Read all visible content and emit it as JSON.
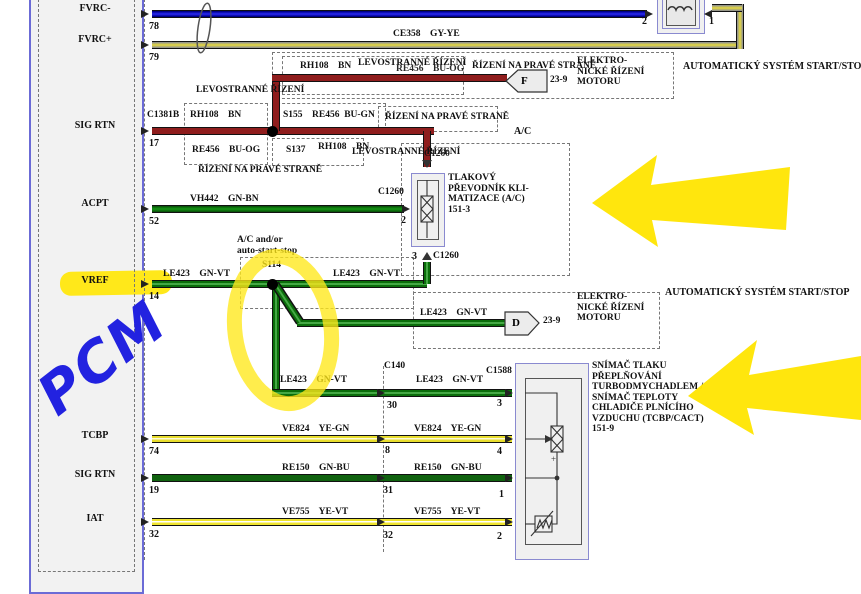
{
  "pcm": {
    "handwritten": "PCM",
    "pins": [
      {
        "label": "FVRC-",
        "num": "78"
      },
      {
        "label": "FVRC+",
        "num": "79"
      },
      {
        "label": "SIG RTN",
        "num": "17"
      },
      {
        "label": "ACPT",
        "num": "52"
      },
      {
        "label": "VREF",
        "num": "14"
      },
      {
        "label": "TCBP",
        "num": "74"
      },
      {
        "label": "SIG RTN",
        "num": "19"
      },
      {
        "label": "IAT",
        "num": "32"
      }
    ]
  },
  "wires": {
    "ce356": "CE356    BU-OG",
    "ce358": "CE358    GY-YE",
    "rh108": "RH108    BN",
    "re456og": "RE456    BU-OG",
    "re456gn": "RE456  BU-GN",
    "vh442": "VH442    GN-BN",
    "le423": "LE423    GN-VT",
    "ve824": "VE824    YE-GN",
    "re150": "RE150    GN-BU",
    "ve755": "VE755    YE-VT"
  },
  "splices": {
    "s155": "S155",
    "s137": "S137",
    "s114": "S114"
  },
  "connectors": {
    "c1381b": "C1381B",
    "c1260": "C1260",
    "c140": "C140",
    "c1588": "C1588",
    "c1260_pins": {
      "p2": "2",
      "p3": "3"
    },
    "c140_pins": {
      "p30": "30",
      "p8": "8",
      "p31": "31",
      "p32": "32"
    },
    "c1588_pins": {
      "p3": "3",
      "p4": "4",
      "p1": "1",
      "p2": "2"
    },
    "inductor_pins": {
      "p2": "2",
      "p1": "1"
    },
    "f": {
      "letter": "F",
      "page": "23-9"
    },
    "d": {
      "letter": "D",
      "page": "23-9"
    }
  },
  "notes": {
    "lhd": "LEVOSTRANNÉ ŘÍZENÍ",
    "rhd": "ŘÍZENÍ NA PRAVÉ STRANĚ",
    "ac": "A/C",
    "ac_andor": "A/C and/or\nauto-start-stop",
    "ass": "AUTOMATICKÝ SYSTÉM START/STOP"
  },
  "components": {
    "ecm": "ELEKTRO-\nNICKÉ ŘÍZENÍ\nMOTORU",
    "ac_transducer": "TLAKOVÝ\nPŘEVODNÍK KLI-\nMATIZACE (A/C)\n151-3",
    "tcbp_sensor": "SNÍMAČ TLAKU\nPŘEPLŇOVÁNÍ\nTURBODMYCHADLEM /\nSNÍMAČ TEPLOTY\nCHLADIČE PLNÍCÍHO\nVZDUCHU (TCBP/CACT)\n151-9"
  },
  "colors": {
    "highlighter": "#ffe81a",
    "handwriting": "#2222e0",
    "wire_brown": "#8f1d1d",
    "wire_green": "#128a12",
    "wire_dark_green": "#10620f",
    "wire_yellow": "#efe42f",
    "wire_blue": "#2121dd",
    "wire_gray_yellow": "#d6cc4e",
    "component_border": "#8a8ad0"
  }
}
